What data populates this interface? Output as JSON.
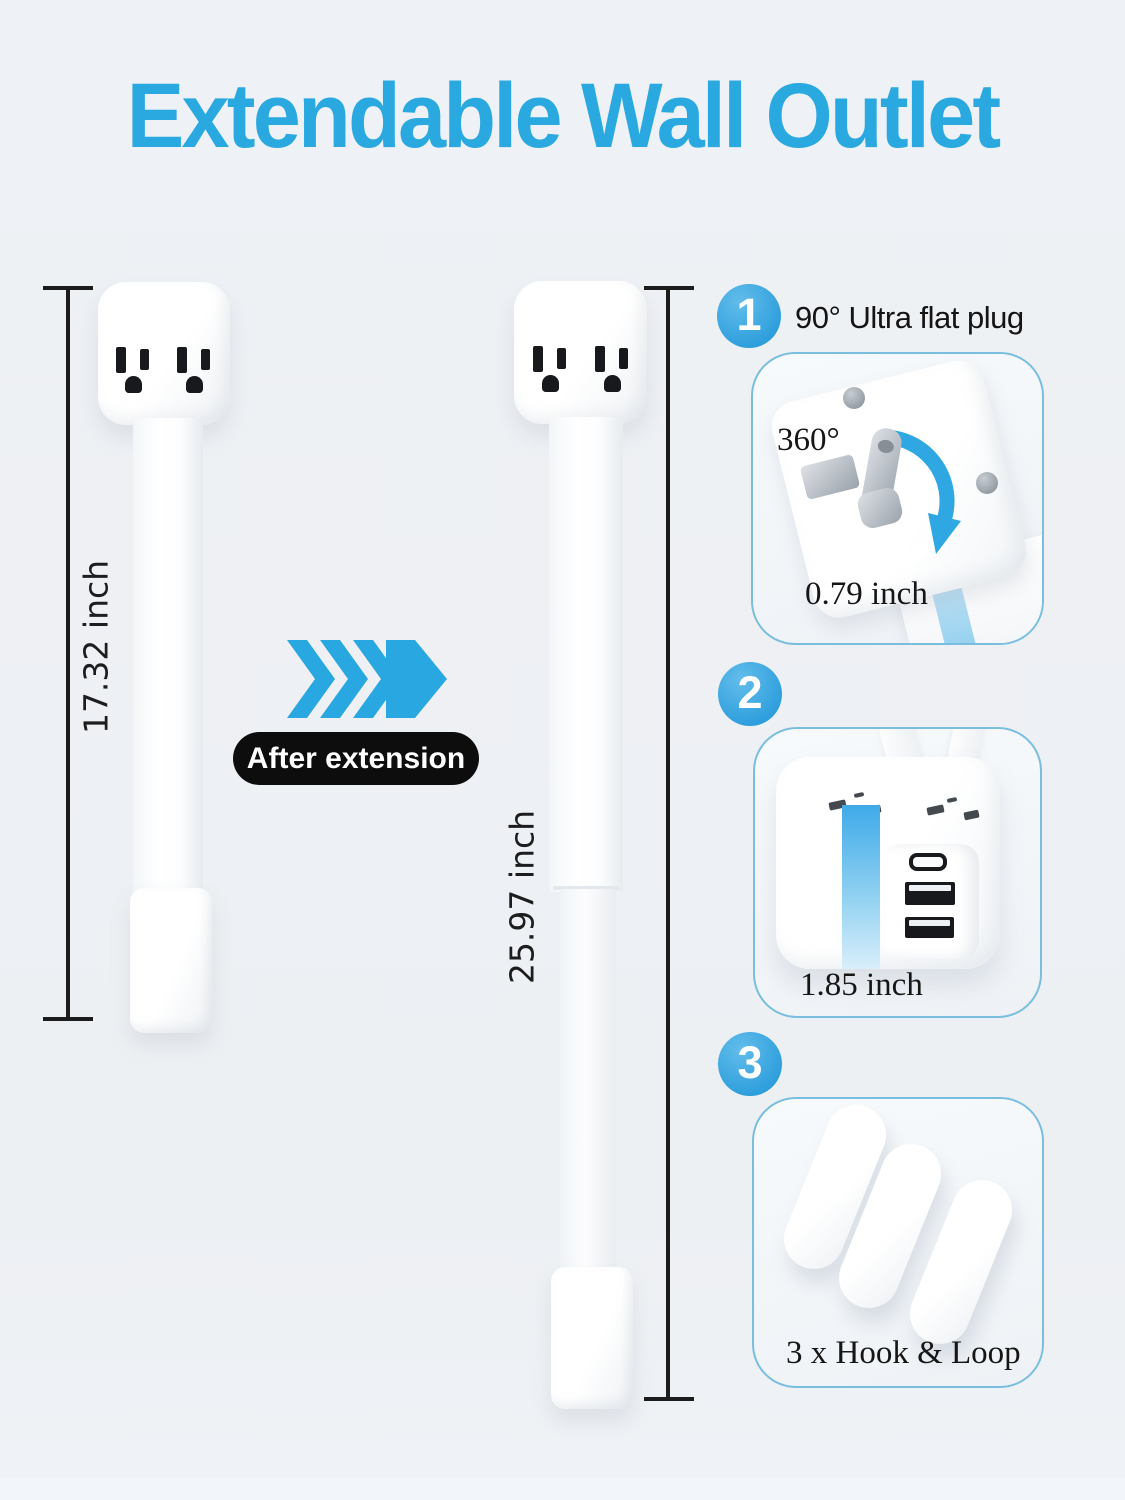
{
  "title": "Extendable Wall Outlet",
  "before": {
    "measurement": "17.32 inch"
  },
  "after": {
    "measurement": "25.97 inch"
  },
  "transition": {
    "badge": "After extension",
    "arrow_icon": "triple-chevron-right-arrow"
  },
  "features": {
    "one": {
      "number": "1",
      "heading": "90° Ultra flat plug",
      "rotation": "360°",
      "size": "0.79 inch",
      "icons": [
        "rotation-arrow",
        "plug-prongs",
        "screws"
      ]
    },
    "two": {
      "number": "2",
      "size": "1.85 inch",
      "icons": [
        "usb-c-port",
        "usb-a-port",
        "usb-a-port"
      ]
    },
    "three": {
      "number": "3",
      "caption": "3 x Hook & Loop",
      "icons": [
        "hook-loop-strip",
        "hook-loop-strip",
        "hook-loop-strip"
      ]
    }
  },
  "colors": {
    "accent_blue": "#2aa9e1",
    "badge_black": "#0d0d0d",
    "box_border_blue": "#79bedf",
    "background": "#edf0f4"
  }
}
